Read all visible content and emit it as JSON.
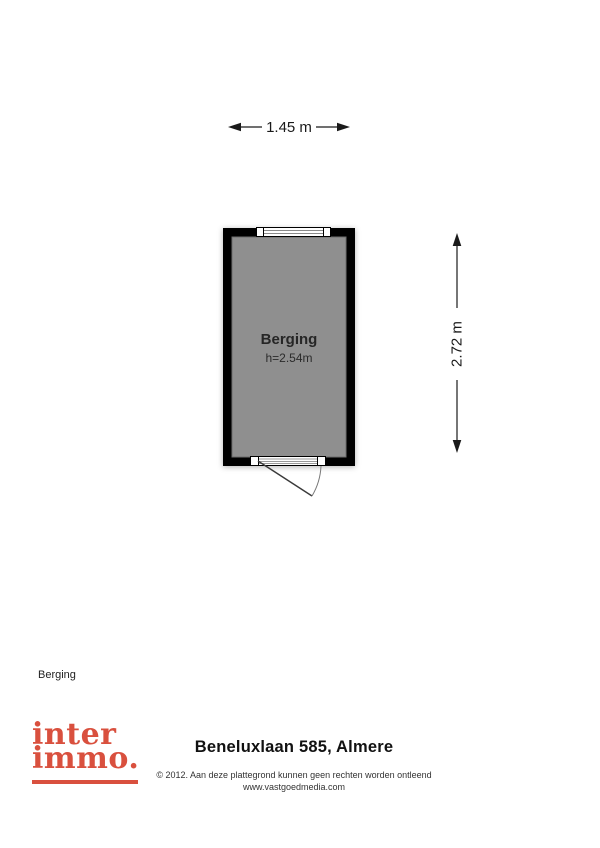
{
  "plan": {
    "width_label": "1.45 m",
    "height_label": "2.72 m",
    "room": {
      "name": "Berging",
      "height_label": "h=2.54m"
    },
    "colors": {
      "wall": "#000000",
      "floor": "#8f8f8f"
    }
  },
  "legend": {
    "room_label": "Berging"
  },
  "footer": {
    "logo": {
      "line1": "inter",
      "line2": "immo.",
      "color": "#d9503e"
    },
    "title": "Beneluxlaan 585, Almere",
    "copyright": "© 2012. Aan deze plattegrond kunnen geen rechten worden ontleend",
    "website": "www.vastgoedmedia.com"
  }
}
